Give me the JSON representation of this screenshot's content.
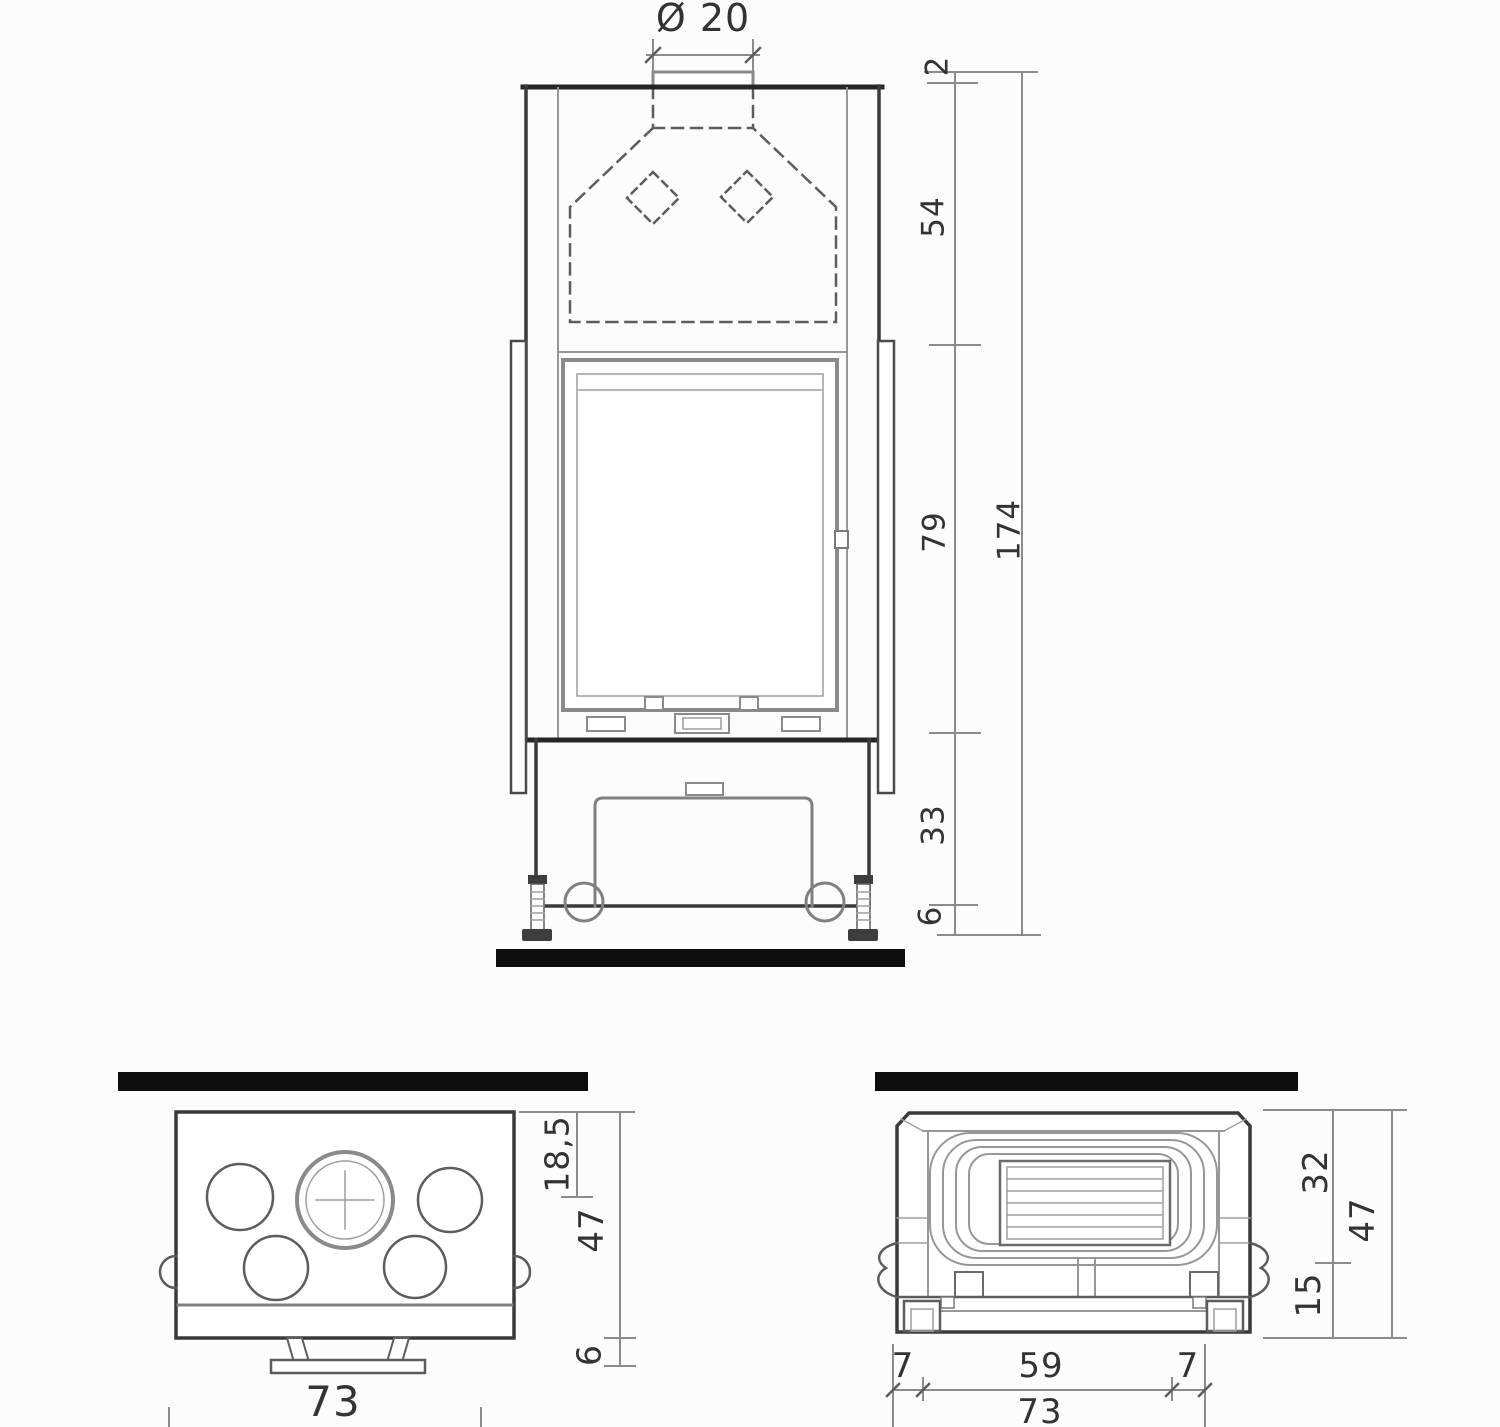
{
  "front_view": {
    "flue_diameter": "Ø 20",
    "dims": {
      "collar": "2",
      "hood": "54",
      "door": "79",
      "base": "33",
      "feet": "6",
      "total": "174"
    }
  },
  "top_view": {
    "dims": {
      "flue_center": "18,5",
      "depth": "47",
      "front": "6",
      "width": "73"
    }
  },
  "bottom_view": {
    "dims": {
      "back": "32",
      "depth": "47",
      "front": "15",
      "left": "7",
      "center": "59",
      "right": "7",
      "width": "73"
    }
  },
  "colors": {
    "line": "#3a3a3a",
    "dimension": "#8c8c8c",
    "wall_bar": "#0d0d0d",
    "background": "#fcfcfc"
  }
}
